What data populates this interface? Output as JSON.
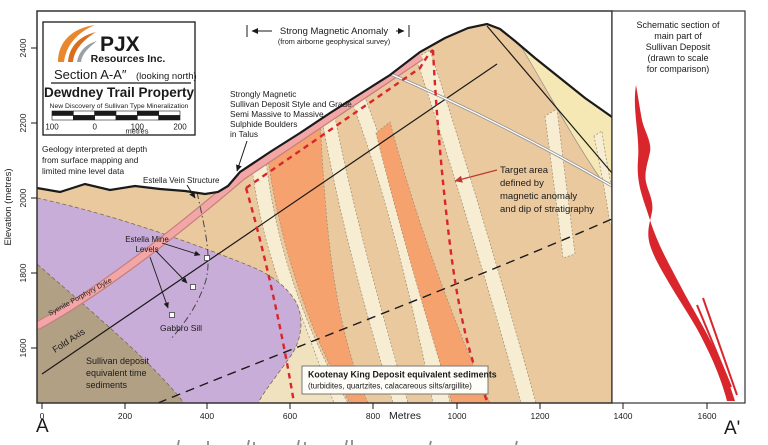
{
  "colors": {
    "tan": "#EBC99E",
    "cream": "#F7EDD3",
    "orange": "#F5A26F",
    "purple": "#C9ADD9",
    "brown": "#B2A084",
    "pale": "#F0E2BE",
    "yellow": "#F5E8B4",
    "pink": "#F2A6A6",
    "pink_border": "#C57F7F",
    "red": "#D8262C",
    "red_text": "#BE3A2E",
    "dyke_label": "#9C3A2A",
    "logo_orange": "#E8872C",
    "logo_dark_orange": "#D96F1E",
    "logo_gray": "#9AA0A8"
  },
  "legend": {
    "logo_text": "PJX",
    "logo_subtext": "Resources Inc.",
    "section_title": "Section A-A″",
    "section_subtitle": "(looking north)",
    "property_title": "Dewdney Trail Property",
    "discovery_line": "New Discovery of Sullivan Type Mineralization",
    "scale": {
      "labels": [
        "100",
        "0",
        "100",
        "200"
      ],
      "unit": "metres"
    }
  },
  "annotations": {
    "magnetic_anomaly": {
      "title": "Strong Magnetic Anomaly",
      "subtitle": "(from airborne geophysical survey)"
    },
    "geology_note": {
      "lines": [
        "Geology interpreted at depth",
        "from surface mapping and",
        "limited mine level data"
      ]
    },
    "estella_vein": "Estella Vein Structure",
    "estella_mine": {
      "lines": [
        "Estella Mine",
        "Levels"
      ]
    },
    "strongly_magnetic": {
      "lines": [
        "Strongly Magnetic",
        "Sullivan Deposit Style and Grade",
        "Semi Massive to Massive",
        "Sulphide Boulders",
        "in Talus"
      ]
    },
    "target_area": {
      "lines": [
        "Target area",
        "defined by",
        "magnetic anomaly",
        "and dip of stratigraphy"
      ]
    },
    "syenite_dyke": "Syenite Porphyry Dyke",
    "fold_axis": "Fold Axis",
    "sullivan_sediments": {
      "lines": [
        "Sullivan deposit",
        "equivalent time",
        "sediments"
      ]
    },
    "gabbro_sill": "Gabbro Sill",
    "kootenay": {
      "line1": "Kootenay King Deposit equivalent sediments",
      "line2": "(turbidites, quartzites, calacareous silts/argillite)"
    }
  },
  "right_panel": {
    "title_lines": [
      "Schematic section of",
      "main part of",
      "Sullivan Deposit",
      "(drawn to scale",
      "for comparison)"
    ]
  },
  "axes": {
    "x": {
      "ticks": [
        "0",
        "200",
        "400",
        "600",
        "800",
        "1000",
        "1200",
        "1400",
        "1600"
      ],
      "unit_label": "Metres",
      "start_label": "A",
      "end_label": "A'"
    },
    "y": {
      "ticks": [
        "2400",
        "2200",
        "2000",
        "1800",
        "1600"
      ],
      "label": "Elevation (metres)"
    }
  }
}
